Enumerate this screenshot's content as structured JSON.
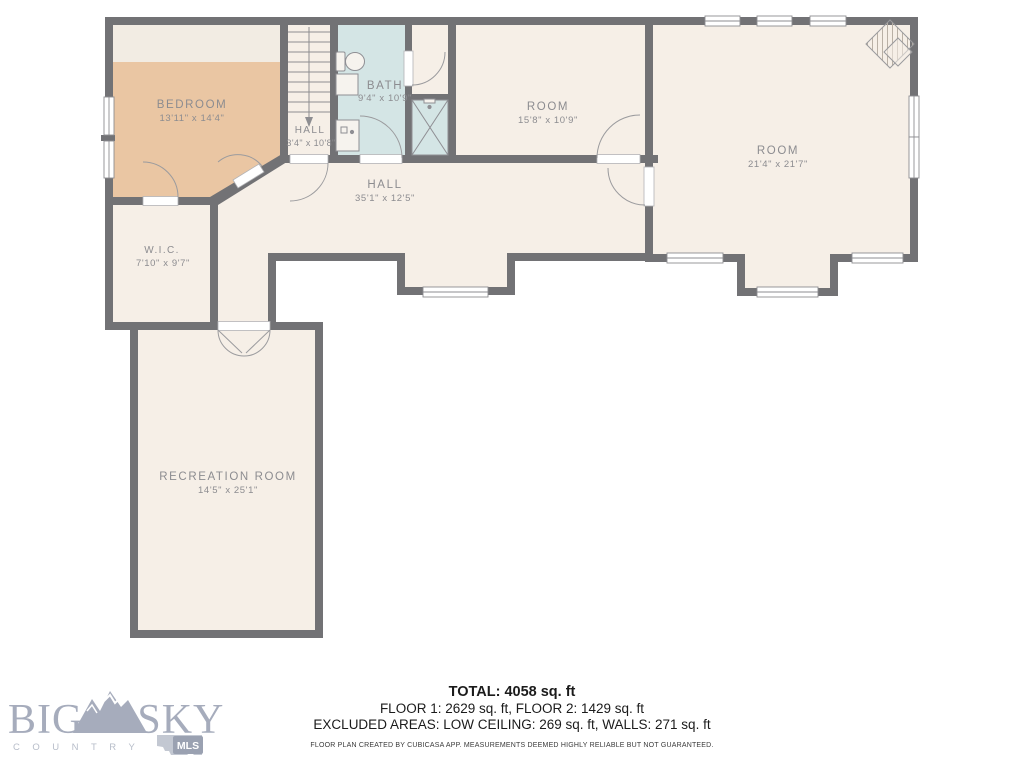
{
  "plan": {
    "rooms": [
      {
        "id": "bedroom",
        "name": "BEDROOM",
        "dims": "13'11\" x 14'4\""
      },
      {
        "id": "hall-stairs",
        "name": "HALL",
        "dims": "3'4\" x 10'8\""
      },
      {
        "id": "bath",
        "name": "BATH",
        "dims": "9'4\" x 10'9\""
      },
      {
        "id": "room-small",
        "name": "ROOM",
        "dims": "15'8\" x 10'9\""
      },
      {
        "id": "room-large",
        "name": "ROOM",
        "dims": "21'4\" x 21'7\""
      },
      {
        "id": "hall-main",
        "name": "HALL",
        "dims": "35'1\" x 12'5\""
      },
      {
        "id": "wic",
        "name": "W.I.C.",
        "dims": "7'10\" x 9'7\""
      },
      {
        "id": "recreation",
        "name": "RECREATION ROOM",
        "dims": "14'5\" x 25'1\""
      }
    ],
    "colors": {
      "wall": "#727275",
      "floor": "#f6efe7",
      "bedroom": "#eac6a3",
      "bath": "#d4e5e5",
      "low_ceiling_band": "#f2ece3",
      "label": "#8c8c90",
      "logo": "#a6acbc"
    }
  },
  "summary": {
    "total": "TOTAL: 4058 sq. ft",
    "floors": "FLOOR 1: 2629 sq. ft, FLOOR 2: 1429 sq. ft",
    "excluded": "EXCLUDED AREAS: LOW CEILING: 269 sq. ft, WALLS: 271 sq. ft",
    "disclaimer": "FLOOR PLAN CREATED BY CUBICASA APP. MEASUREMENTS DEEMED HIGHLY RELIABLE BUT NOT GUARANTEED."
  },
  "logo": {
    "big": "BIG",
    "sky": "SKY",
    "country": "COUNTRY",
    "mls": "MLS"
  }
}
